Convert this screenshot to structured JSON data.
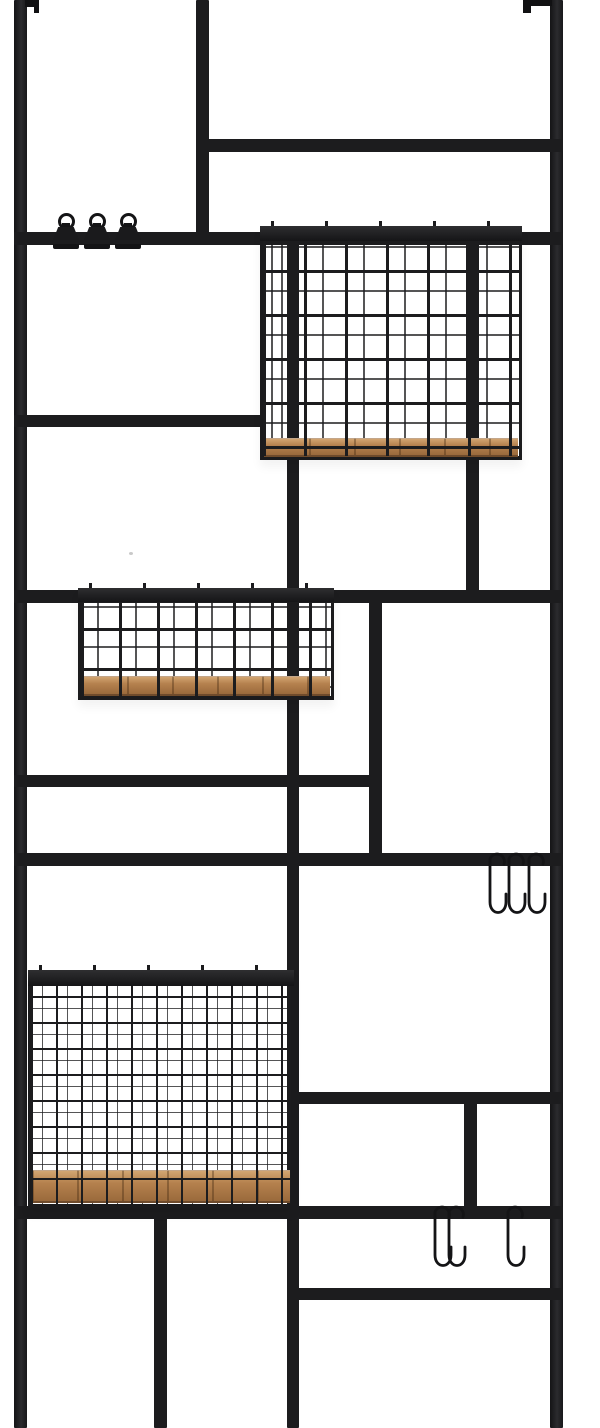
{
  "meta": {
    "image_type": "product photo",
    "subject": "wall-mounted black metal grid wall organizer with wire baskets, wooden shelf bases, S-hooks and clips",
    "background_color": "#ffffff"
  },
  "palette": {
    "frame": "#1c1c1e",
    "frame_dark": "#141416",
    "wood_mid": "#b5814e",
    "wood_light": "#d2a571",
    "wood_dark": "#9a6a3c",
    "background": "#ffffff"
  },
  "counts": {
    "baskets": 3,
    "s_hooks": 6,
    "clips": 3,
    "wall_brackets": 2
  },
  "scene": {
    "bars": [
      {
        "name": "rail-left",
        "rail": true,
        "x": 14,
        "y": 0,
        "w": 13,
        "h": 1428
      },
      {
        "name": "rail-right",
        "rail": true,
        "x": 550,
        "y": 0,
        "w": 13,
        "h": 1428
      },
      {
        "name": "divider-top-vertical",
        "x": 196,
        "y": 0,
        "w": 13,
        "h": 245
      },
      {
        "name": "divider-upper-right-vertical",
        "x": 466,
        "y": 240,
        "w": 13,
        "h": 356
      },
      {
        "name": "divider-center-vertical",
        "x": 287,
        "y": 238,
        "w": 12,
        "h": 1190
      },
      {
        "name": "divider-mid-vertical",
        "x": 369,
        "y": 596,
        "w": 13,
        "h": 264
      },
      {
        "name": "divider-lower-right-vertical",
        "x": 464,
        "y": 1098,
        "w": 13,
        "h": 116
      },
      {
        "name": "divider-bottom-left-vertical",
        "x": 154,
        "y": 1212,
        "w": 13,
        "h": 216
      },
      {
        "name": "shelf-bar-top-right",
        "x": 196,
        "y": 139,
        "w": 367,
        "h": 13
      },
      {
        "name": "clip-bar",
        "x": 14,
        "y": 232,
        "w": 549,
        "h": 13
      },
      {
        "name": "shelf-bar-left-mid",
        "x": 14,
        "y": 415,
        "w": 248,
        "h": 12
      },
      {
        "name": "shelf-bar-basket2",
        "x": 14,
        "y": 590,
        "w": 549,
        "h": 13
      },
      {
        "name": "shelf-bar-left-lower",
        "x": 14,
        "y": 775,
        "w": 368,
        "h": 12
      },
      {
        "name": "hook-bar-upper",
        "x": 14,
        "y": 853,
        "w": 549,
        "h": 13
      },
      {
        "name": "shelf-bar-right-lower",
        "x": 287,
        "y": 1092,
        "w": 276,
        "h": 12
      },
      {
        "name": "hook-bar-lower",
        "x": 14,
        "y": 1206,
        "w": 549,
        "h": 13
      },
      {
        "name": "shelf-bar-bottom-right",
        "x": 287,
        "y": 1288,
        "w": 276,
        "h": 12
      }
    ],
    "brackets": [
      {
        "name": "wall-bracket-left-tab",
        "x": 25,
        "y": 0,
        "w": 14,
        "h": 7
      },
      {
        "name": "wall-bracket-left-lip",
        "x": 34,
        "y": 0,
        "w": 5,
        "h": 13
      },
      {
        "name": "wall-bracket-right-tab",
        "x": 523,
        "y": 0,
        "w": 29,
        "h": 6
      },
      {
        "name": "wall-bracket-right-lip",
        "x": 523,
        "y": 0,
        "w": 8,
        "h": 13
      }
    ],
    "baskets": [
      {
        "name": "wire-basket-upper",
        "x": 260,
        "y": 226,
        "w": 262,
        "h": 234,
        "rim_h": 15,
        "wood_top": 212,
        "wood_h": 16,
        "grid_v": 41,
        "grid_h": 44,
        "wire_w": 3,
        "back_dx": 18,
        "back_dy": 20
      },
      {
        "name": "wire-basket-middle",
        "x": 78,
        "y": 588,
        "w": 256,
        "h": 112,
        "rim_h": 14,
        "wood_top": 88,
        "wood_h": 17,
        "grid_v": 38,
        "grid_h": 40,
        "wire_w": 3,
        "back_dx": 16,
        "back_dy": 18
      },
      {
        "name": "wire-basket-lower",
        "x": 28,
        "y": 970,
        "w": 266,
        "h": 238,
        "rim_h": 16,
        "wood_top": 200,
        "wood_h": 30,
        "grid_v": 25,
        "grid_h": 26,
        "wire_w": 2,
        "back_dx": 11,
        "back_dy": 12
      }
    ],
    "hooks": [
      {
        "name": "s-hook",
        "cx": 498,
        "top": 845
      },
      {
        "name": "s-hook",
        "cx": 517,
        "top": 845
      },
      {
        "name": "s-hook",
        "cx": 537,
        "top": 845
      },
      {
        "name": "s-hook",
        "cx": 443,
        "top": 1198
      },
      {
        "name": "s-hook",
        "cx": 457,
        "top": 1198
      },
      {
        "name": "s-hook",
        "cx": 516,
        "top": 1198
      }
    ],
    "hook_path": "M19 19 A7 7 0 1 0 5 14 L5 57 C5 71 21 71 21 57 L21 49",
    "clips": [
      {
        "name": "binder-clip",
        "cx": 66
      },
      {
        "name": "binder-clip",
        "cx": 97
      },
      {
        "name": "binder-clip",
        "cx": 128
      }
    ],
    "clip_bar_y": 232,
    "specks": [
      {
        "name": "dust-speck",
        "x": 129,
        "y": 552
      }
    ]
  }
}
